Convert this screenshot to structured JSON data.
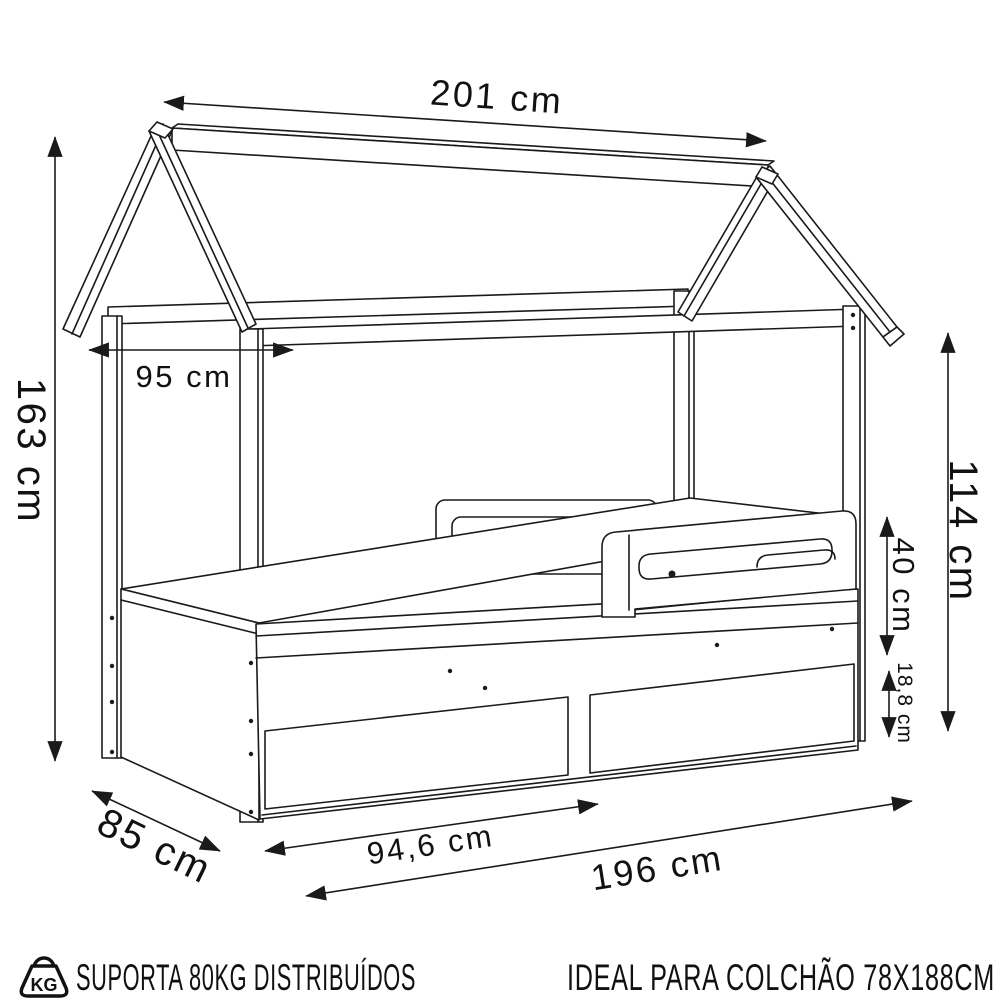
{
  "diagram": {
    "dimensions": {
      "total_width": "201 cm",
      "inner_width": "95 cm",
      "left_height": "163 cm",
      "right_height": "114 cm",
      "guard_rail_height": "40 cm",
      "drawer_front_height": "18,8 cm",
      "depth": "85 cm",
      "drawer_width": "94,6 cm",
      "base_length": "196 cm"
    },
    "footer": {
      "kg_badge": "KG",
      "weight_capacity": "SUPORTA 80KG DISTRIBUÍDOS",
      "mattress_recommendation": "IDEAL PARA COLCHÃO 78X188CM"
    },
    "colors": {
      "line": "#1a1a1a",
      "text": "#111111",
      "background": "#ffffff"
    }
  }
}
